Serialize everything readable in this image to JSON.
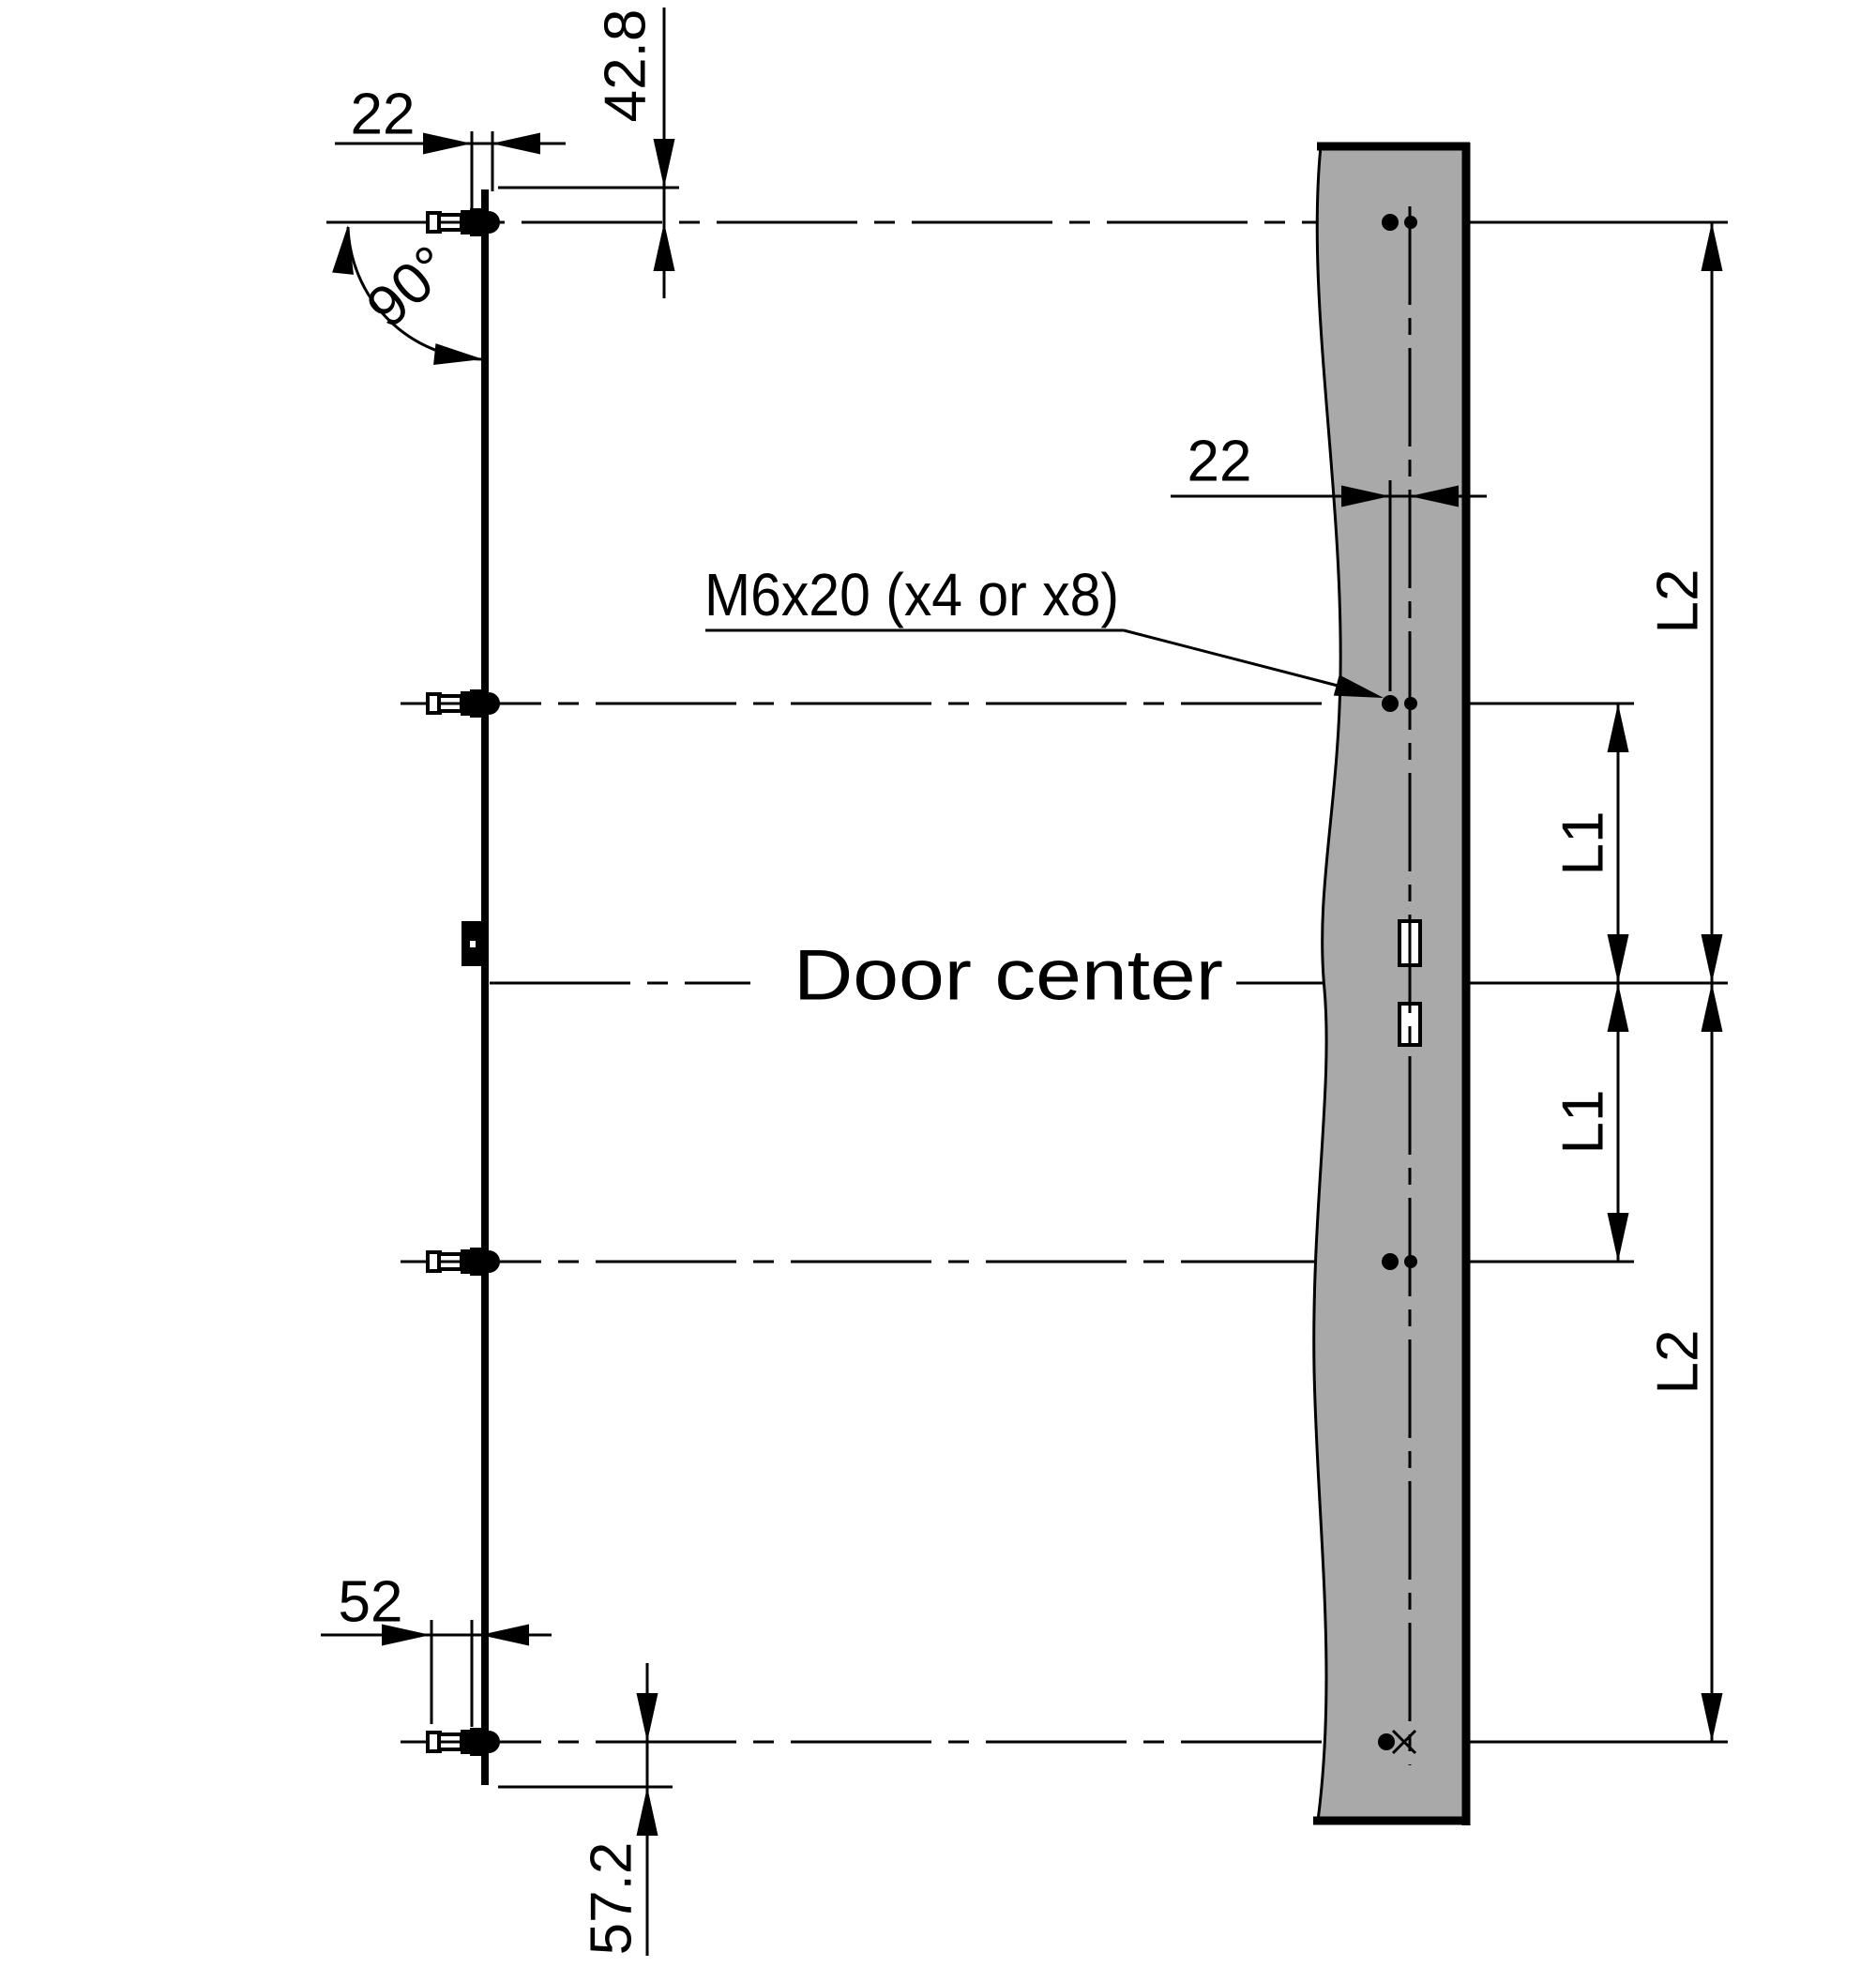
{
  "drawing": {
    "type": "technical-installation-diagram",
    "colors": {
      "background": "#ffffff",
      "line": "#000000",
      "panel_fill": "#a9a9a9"
    },
    "labels": {
      "screw_spec": "M6x20 (x4 or x8)",
      "door_center": "Door center",
      "angle": "90°"
    },
    "dimensions": {
      "hinge_offset_top": "22",
      "top_inset": "42.8",
      "panel_screw_offset": "22",
      "l2_upper": "L2",
      "l1_upper": "L1",
      "l1_lower": "L1",
      "l2_lower": "L2",
      "bolt_length": "52",
      "bottom_inset": "57.2"
    }
  }
}
